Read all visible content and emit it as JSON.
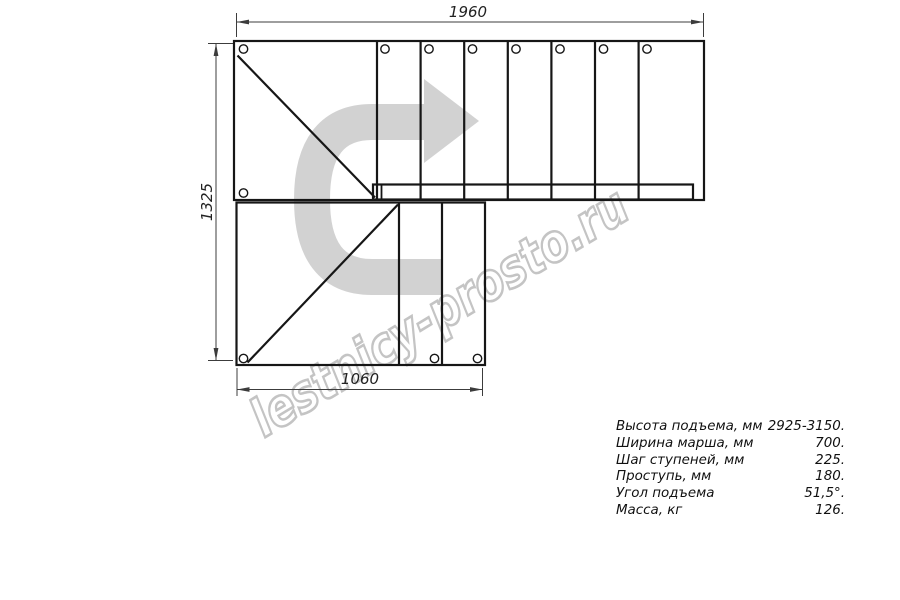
{
  "drawing": {
    "title": "staircase-plan-top-view",
    "dim_top": "1960",
    "dim_left": "1325",
    "dim_bottom": "1060",
    "watermark_text": "lestnicy-prosto.ru"
  },
  "specs": {
    "rows": [
      {
        "label": "Высота подъема, мм",
        "value": "2925-3150."
      },
      {
        "label": "Ширина марша, мм",
        "value": "700."
      },
      {
        "label": "Шаг ступеней, мм",
        "value": "225."
      },
      {
        "label": "Проступь, мм",
        "value": "180."
      },
      {
        "label": "Угол подъема",
        "value": "51,5°."
      },
      {
        "label": "Масса, кг",
        "value": "126."
      }
    ]
  },
  "colors": {
    "outline": "#161616",
    "dimension_lines": "#3c3c3c",
    "watermark_arrow_fill": "#d2d2d2",
    "watermark_text_outline": "#c4c4c4",
    "canvas_background": "#ffffff"
  }
}
